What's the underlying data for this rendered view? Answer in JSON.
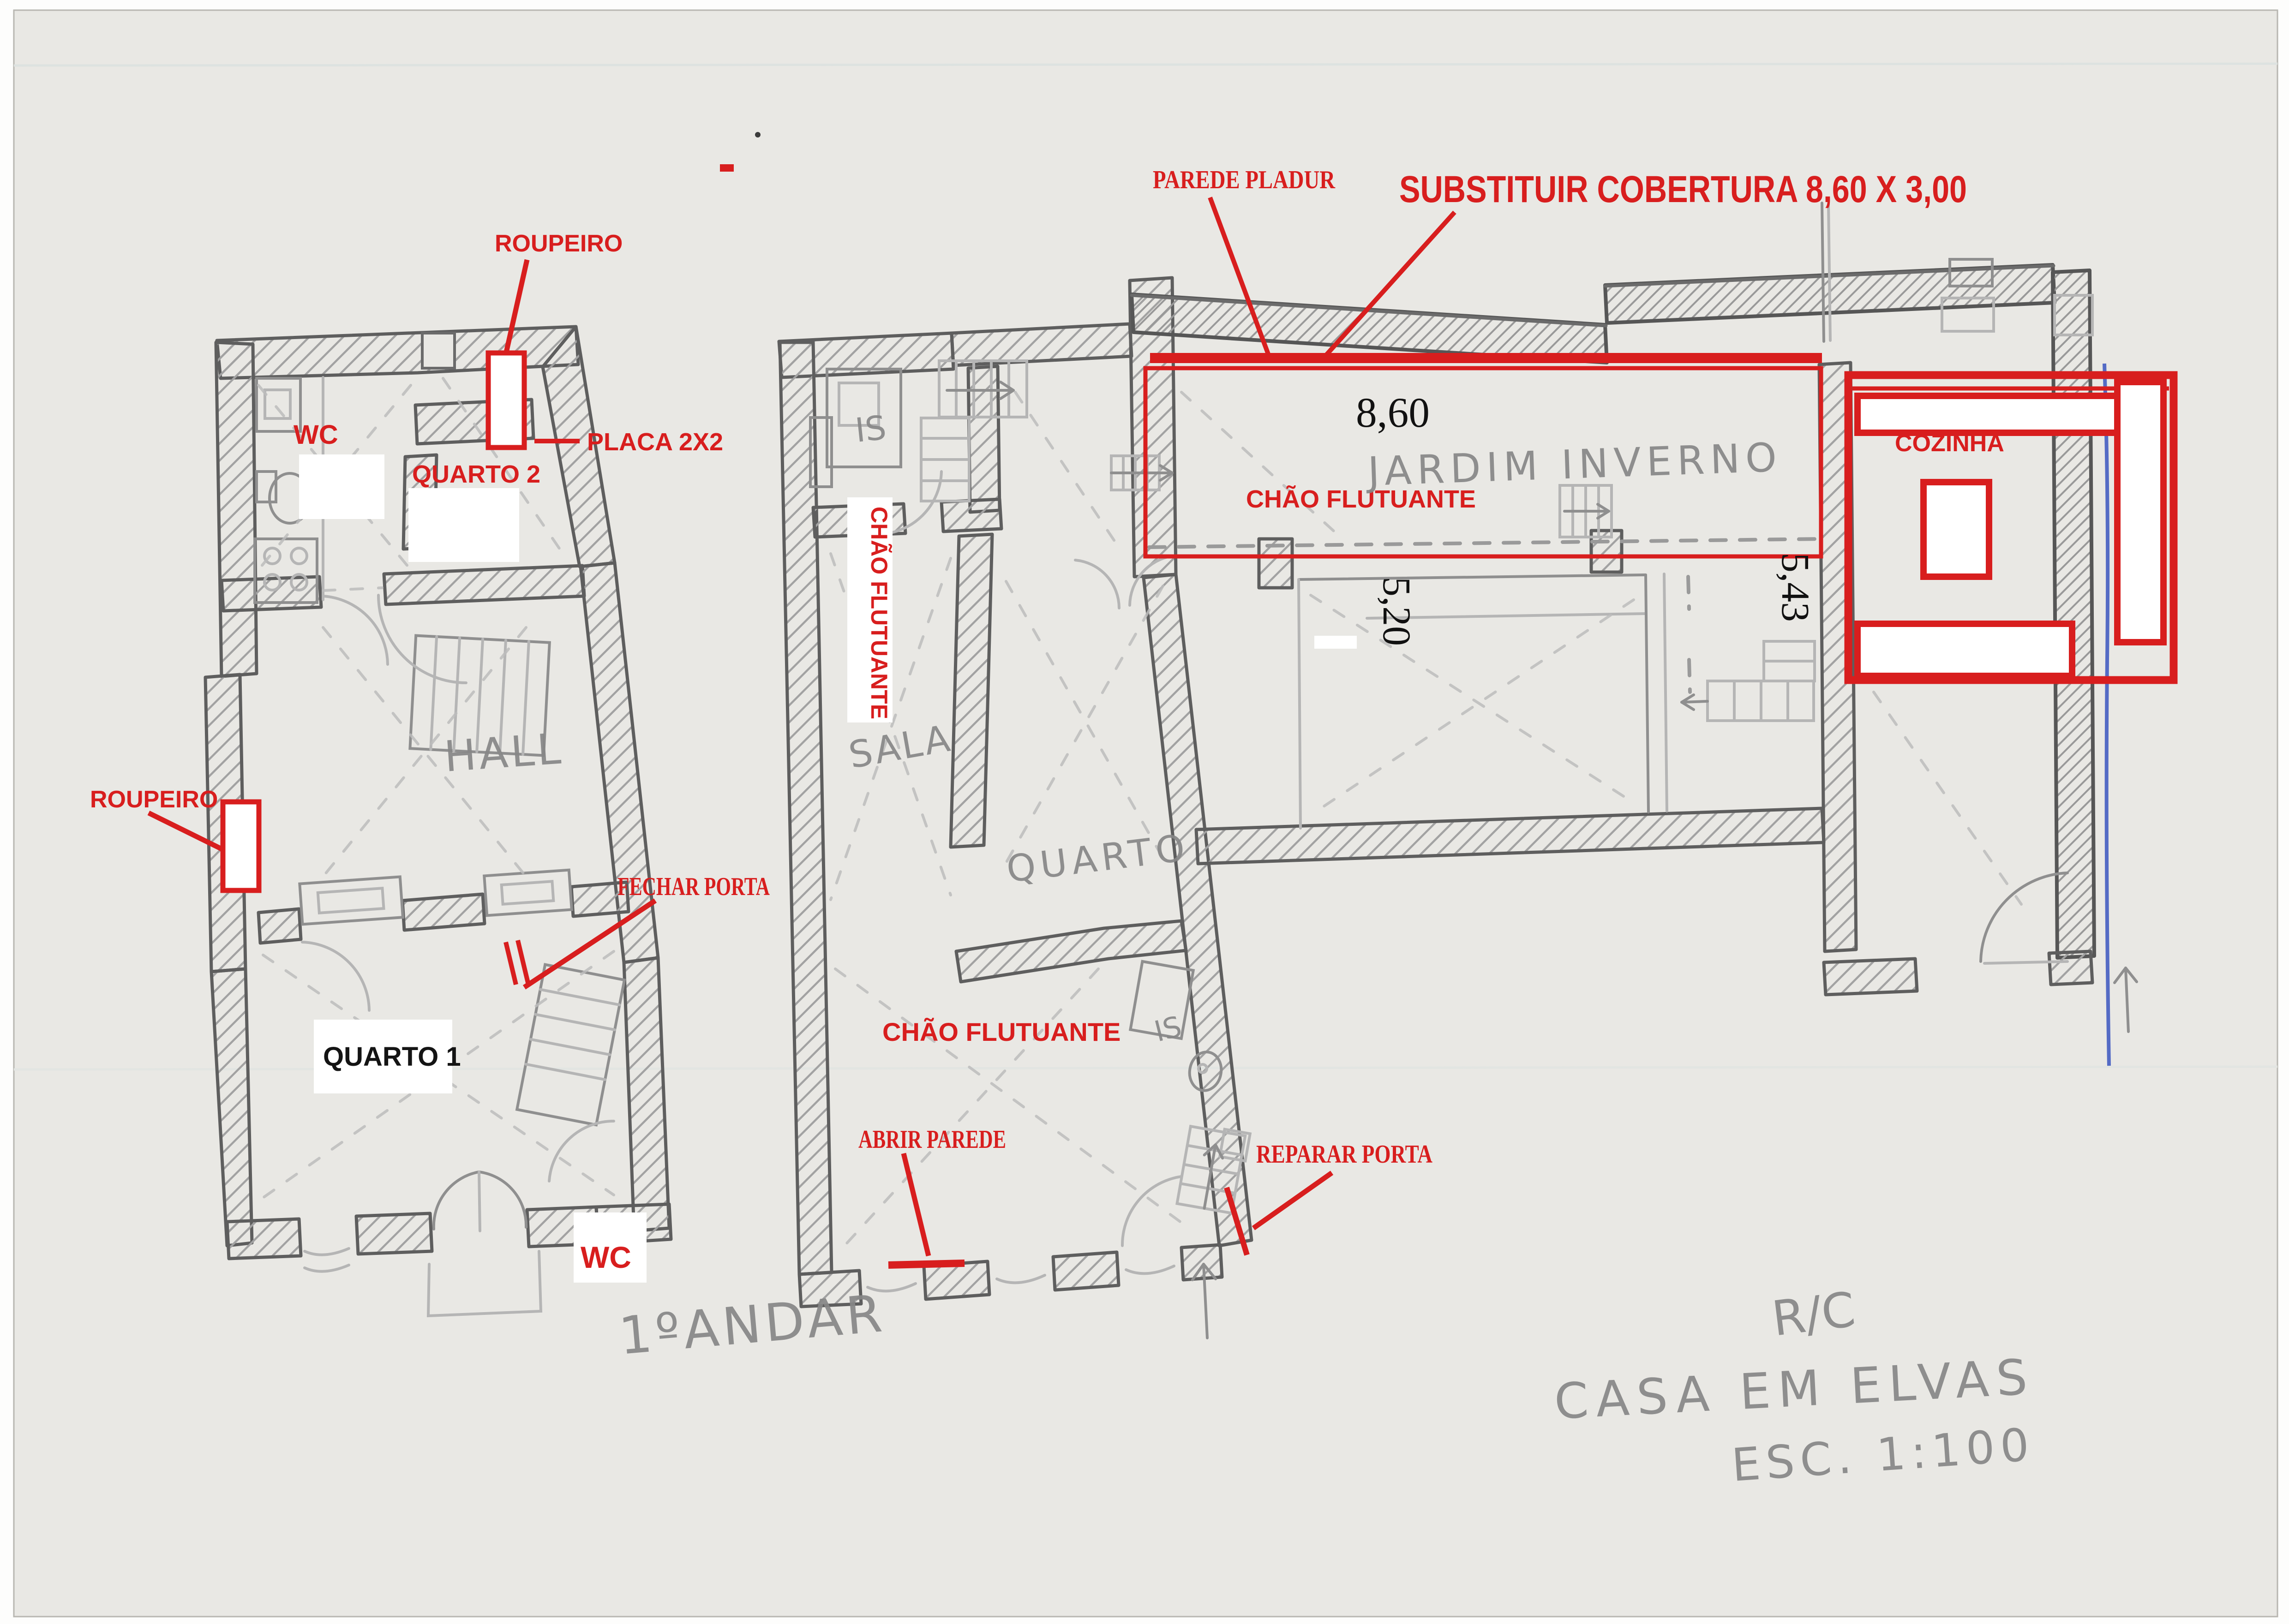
{
  "page": {
    "title": "CASA EM ELVAS — esboço de plantas (digitalização)"
  },
  "pencil": {
    "hall": "HALL",
    "sala": "SALA",
    "quarto": "QUARTO",
    "is_top": "IS",
    "is_bottom": "IS",
    "jardim_inverno": "JARDIM INVERNO",
    "floor_label_left": "1ºANDAR",
    "floor_label_right": "R/C",
    "project_title": "CASA EM ELVAS",
    "scale_label": "ESC. 1:100"
  },
  "black": {
    "quarto1": "QUARTO 1",
    "dim_width": "8,60",
    "dim_left": "5,20",
    "dim_right": "5,43"
  },
  "red": {
    "roupeiro_top": "ROUPEIRO",
    "roupeiro_left": "ROUPEIRO",
    "wc_top": "WC",
    "wc_bottom": "WC",
    "quarto2": "QUARTO 2",
    "placa": "PLACA 2X2",
    "fechar_porta": "FECHAR PORTA",
    "parede_pladur": "PAREDE PLADUR",
    "substituir_cobertura": "SUBSTITUIR COBERTURA 8,60 X 3,00",
    "chao_flutuante_v": "CHÃO FLUTUANTE",
    "chao_flutuante_mid": "CHÃO FLUTUANTE",
    "chao_flutuante_jardim": "CHÃO FLUTUANTE",
    "abrir_parede": "ABRIR PAREDE",
    "reparar_porta": "REPARAR PORTA",
    "cozinha": "COZINHA"
  },
  "colors": {
    "annotation_red": "#d81e1e",
    "pencil_dark": "#5e5e5e",
    "pencil_mid": "#8f8f8f",
    "paper": "#e9e8e4",
    "scanner_white": "#fdfdfc",
    "blue_pen": "#3a55c0"
  }
}
